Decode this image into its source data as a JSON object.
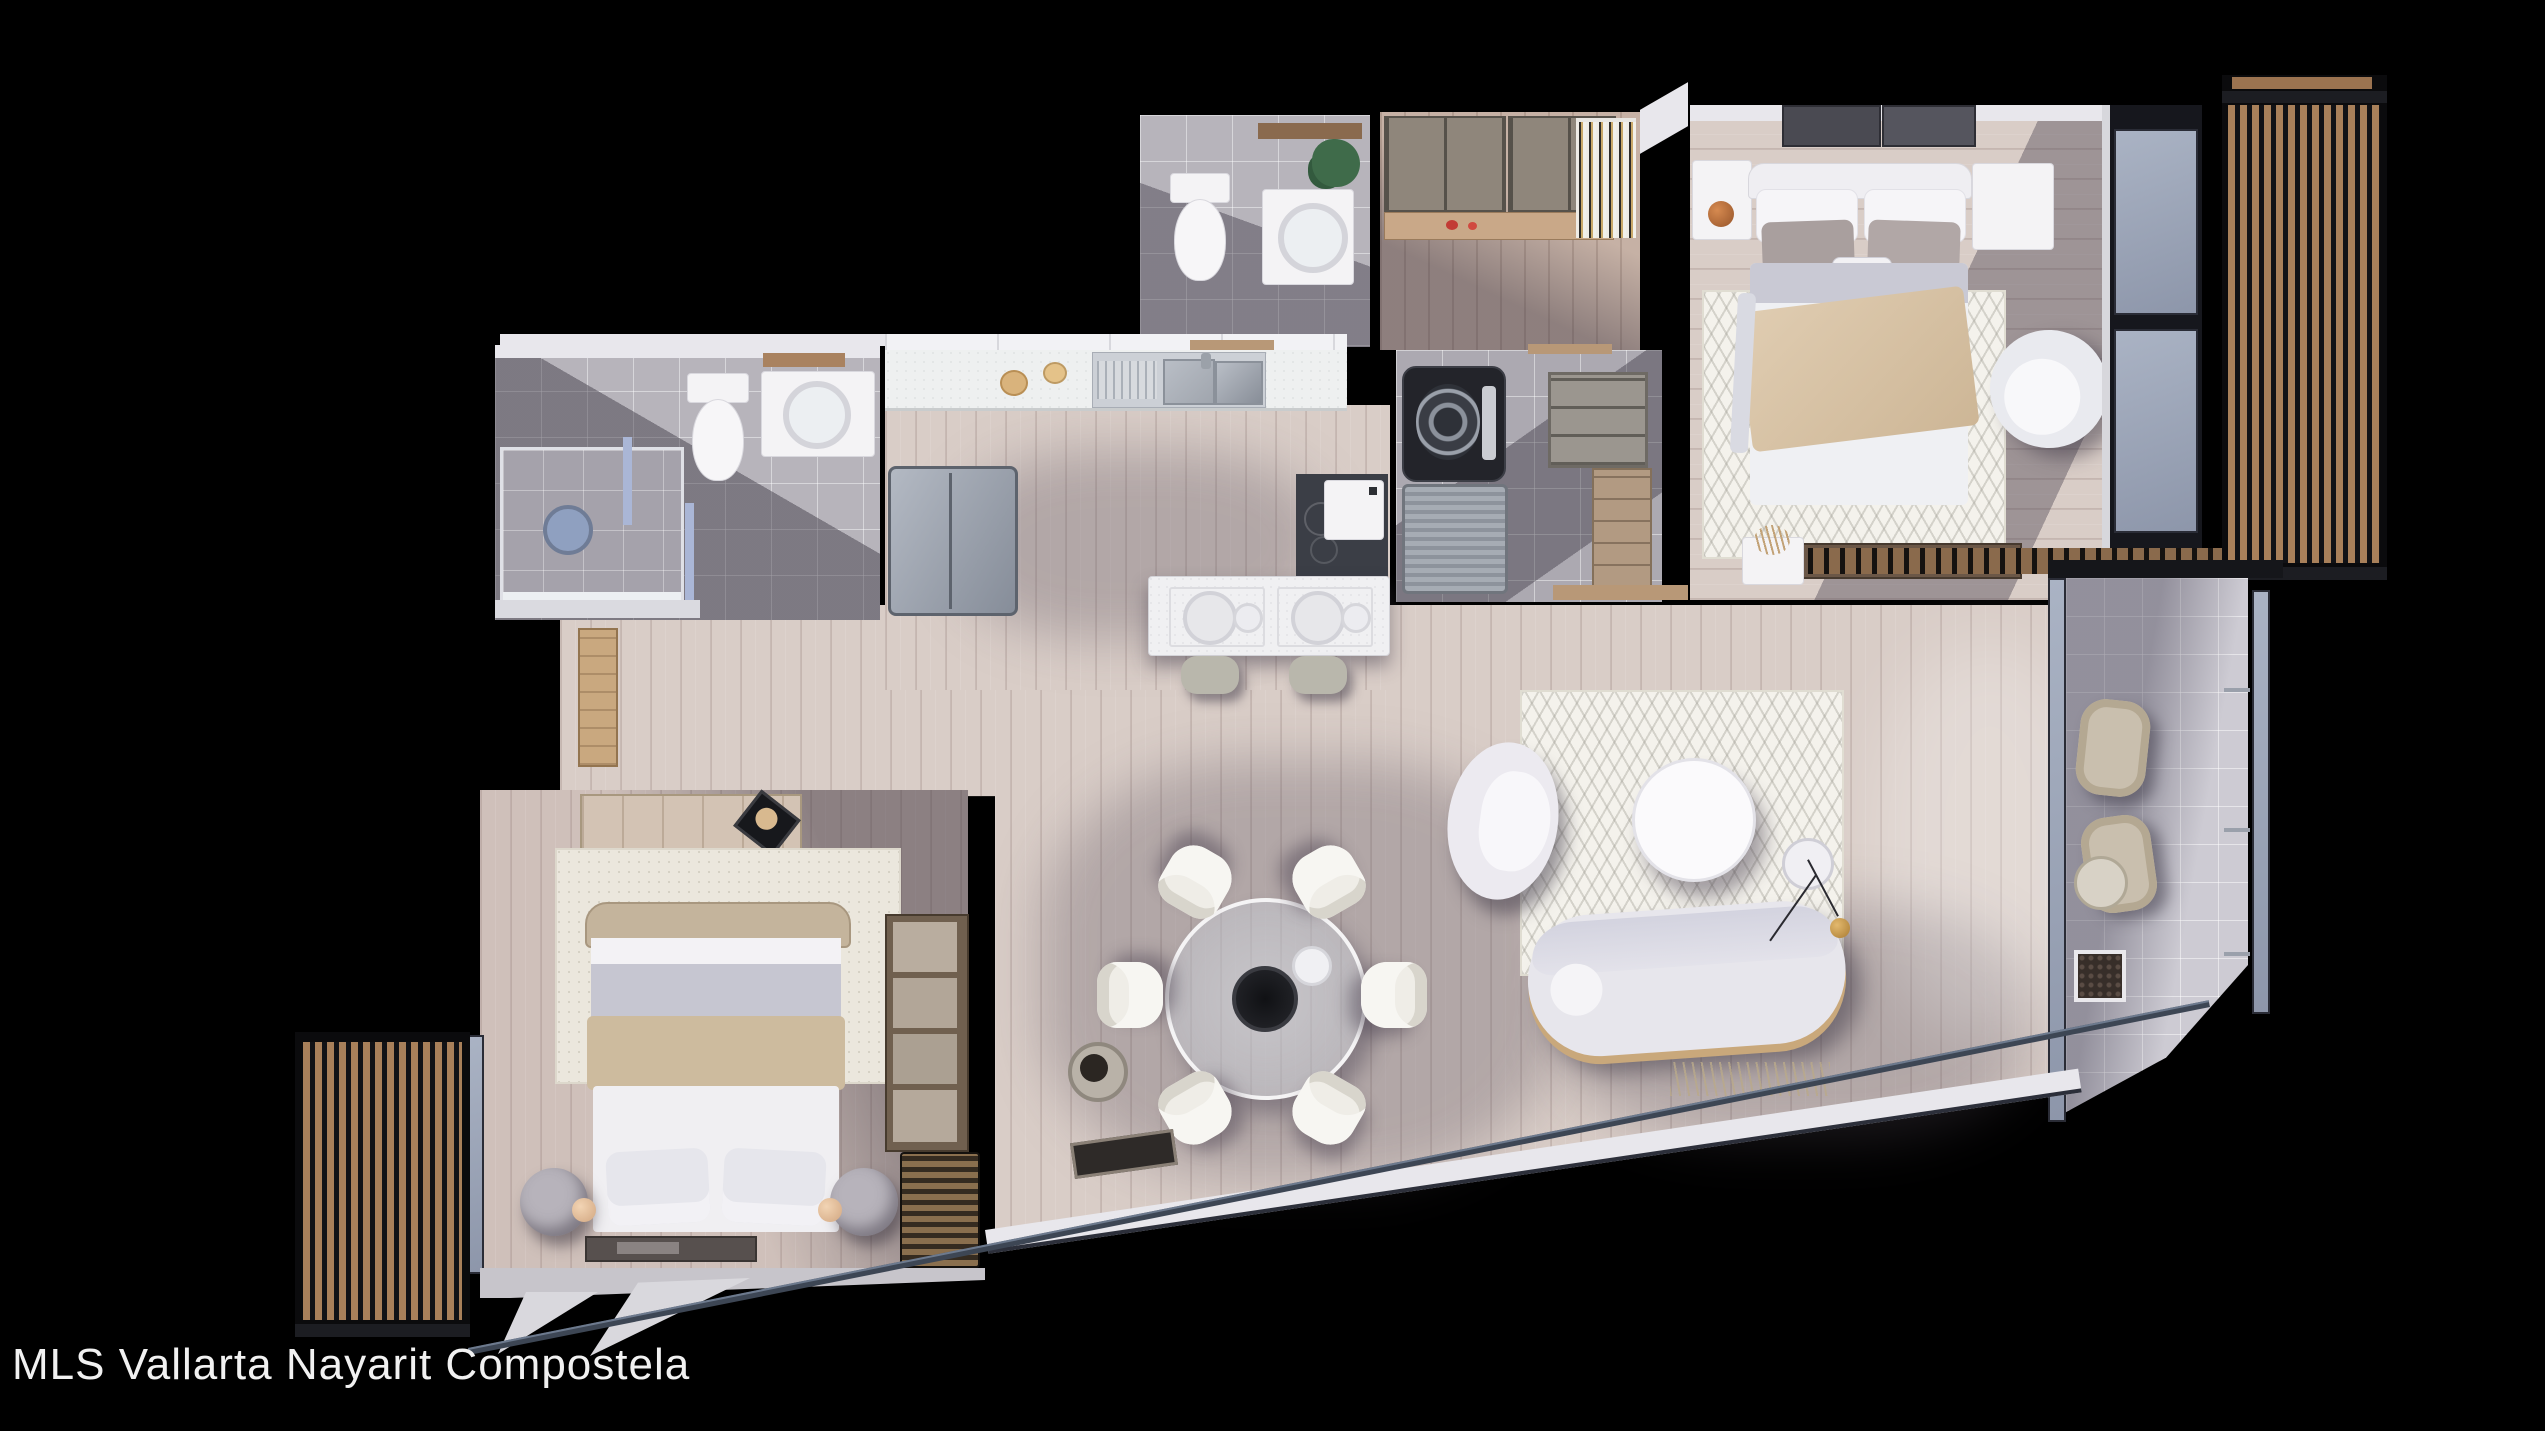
{
  "watermark": {
    "text": "MLS Vallarta Nayarit Compostela"
  },
  "palette": {
    "background": "#000000",
    "wall_dark": "#101014",
    "wall_white": "#e8e7ec",
    "wood_floor": "#d9cdc7",
    "closet_floor": "#c6b1a5",
    "tile_floor": "#b7b4bb",
    "terrace_tile": "#cdcbd3",
    "wood_slats": "#a8805a",
    "fixture_white": "#f4f3f5",
    "counter_white": "#eef0f0",
    "appliance_gray": "#9aa0ac",
    "appliance_dark": "#35373f",
    "glass_blue": "#aab3c4",
    "rug_living": "#f4f2ec",
    "rug_bedroom": "#ebe7dd",
    "bed_throw_tan": "#d7c2a7",
    "bed_sheet_gray": "#c6c6d1",
    "plant_green": "#3f6b4a",
    "lamp_copper": "#b06a3a",
    "edge_line_blue": "#6d7a8e"
  }
}
